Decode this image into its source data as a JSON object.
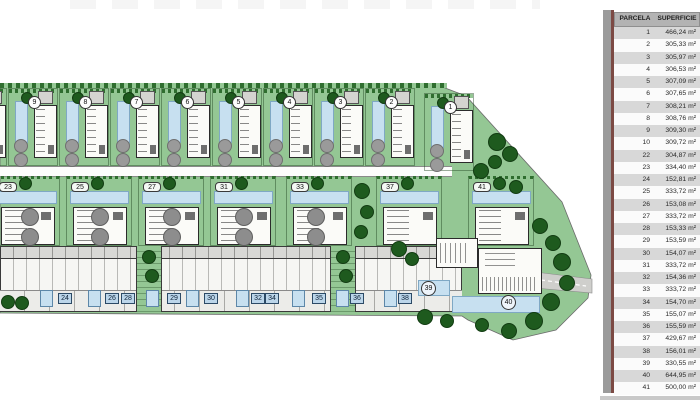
{
  "colors": {
    "site_green": "#94c794",
    "tree_green": "#1e5a1e",
    "pool_blue": "#c7e0f0",
    "road_gray": "#cfcfcc",
    "table_header_bg": "#b3b3b3",
    "table_row_gray": "#d8d8d8",
    "divider_red": "#7c4a44"
  },
  "table": {
    "headers": [
      "PARCELA",
      "SUPERFICIE"
    ],
    "rows": [
      {
        "parcela": "1",
        "superficie": "466,24 m²"
      },
      {
        "parcela": "2",
        "superficie": "305,33 m²"
      },
      {
        "parcela": "3",
        "superficie": "305,97 m²"
      },
      {
        "parcela": "4",
        "superficie": "306,53 m²"
      },
      {
        "parcela": "5",
        "superficie": "307,09 m²"
      },
      {
        "parcela": "6",
        "superficie": "307,65 m²"
      },
      {
        "parcela": "7",
        "superficie": "308,21 m²"
      },
      {
        "parcela": "8",
        "superficie": "308,76 m²"
      },
      {
        "parcela": "9",
        "superficie": "309,30 m²"
      },
      {
        "parcela": "10",
        "superficie": "309,72 m²"
      },
      {
        "parcela": "22",
        "superficie": "304,87 m²"
      },
      {
        "parcela": "23",
        "superficie": "334,40 m²"
      },
      {
        "parcela": "24",
        "superficie": "152,81 m²"
      },
      {
        "parcela": "25",
        "superficie": "333,72 m²"
      },
      {
        "parcela": "26",
        "superficie": "153,08 m²"
      },
      {
        "parcela": "27",
        "superficie": "333,72 m²"
      },
      {
        "parcela": "28",
        "superficie": "153,33 m²"
      },
      {
        "parcela": "29",
        "superficie": "153,59 m²"
      },
      {
        "parcela": "30",
        "superficie": "154,07 m²"
      },
      {
        "parcela": "31",
        "superficie": "333,72 m²"
      },
      {
        "parcela": "32",
        "superficie": "154,36 m²"
      },
      {
        "parcela": "33",
        "superficie": "333,72 m²"
      },
      {
        "parcela": "34",
        "superficie": "154,70 m²"
      },
      {
        "parcela": "35",
        "superficie": "155,07 m²"
      },
      {
        "parcela": "36",
        "superficie": "155,59 m²"
      },
      {
        "parcela": "37",
        "superficie": "429,67 m²"
      },
      {
        "parcela": "38",
        "superficie": "156,01 m²"
      },
      {
        "parcela": "39",
        "superficie": "330,55 m²"
      },
      {
        "parcela": "40",
        "superficie": "644,95 m²"
      },
      {
        "parcela": "41",
        "superficie": "500,00 m²"
      }
    ]
  },
  "plan": {
    "corner_plots": {
      "p39": "39",
      "p40": "40"
    },
    "top_villas": [
      {
        "num": "10",
        "x": -43
      },
      {
        "num": "9",
        "x": 8
      },
      {
        "num": "8",
        "x": 59
      },
      {
        "num": "7",
        "x": 110
      },
      {
        "num": "6",
        "x": 161
      },
      {
        "num": "5",
        "x": 212
      },
      {
        "num": "4",
        "x": 263
      },
      {
        "num": "3",
        "x": 314
      },
      {
        "num": "2",
        "x": 365
      },
      {
        "num": "1",
        "x": 424,
        "y": 93
      }
    ],
    "middle_villas": [
      {
        "num": "23",
        "x": -6
      },
      {
        "num": "25",
        "x": 66
      },
      {
        "num": "27",
        "x": 138
      },
      {
        "num": "31",
        "x": 210
      },
      {
        "num": "33",
        "x": 286
      },
      {
        "num": "37",
        "x": 376
      },
      {
        "num": "41",
        "x": 468
      }
    ],
    "townhouse_labels": [
      {
        "num": "24",
        "x": 58
      },
      {
        "num": "26",
        "x": 105
      },
      {
        "num": "28",
        "x": 121
      },
      {
        "num": "29",
        "x": 167
      },
      {
        "num": "30",
        "x": 204
      },
      {
        "num": "32",
        "x": 251
      },
      {
        "num": "34",
        "x": 265
      },
      {
        "num": "35",
        "x": 312
      },
      {
        "num": "36",
        "x": 350
      },
      {
        "num": "38",
        "x": 398
      }
    ],
    "townhouse_pools": [
      {
        "x": 40
      },
      {
        "x": 88
      },
      {
        "x": 146
      },
      {
        "x": 186
      },
      {
        "x": 236
      },
      {
        "x": 292
      },
      {
        "x": 336
      },
      {
        "x": 384
      }
    ],
    "gray_pairs": [
      {
        "x": 21
      },
      {
        "x": 91
      },
      {
        "x": 163
      },
      {
        "x": 235
      },
      {
        "x": 307
      }
    ],
    "trees": [
      {
        "x": 488,
        "y": 133,
        "s": 18
      },
      {
        "x": 502,
        "y": 146,
        "s": 16
      },
      {
        "x": 488,
        "y": 155,
        "s": 14
      },
      {
        "x": 473,
        "y": 163,
        "s": 16
      },
      {
        "x": 509,
        "y": 180,
        "s": 14
      },
      {
        "x": 532,
        "y": 218,
        "s": 16
      },
      {
        "x": 545,
        "y": 235,
        "s": 16
      },
      {
        "x": 553,
        "y": 253,
        "s": 18
      },
      {
        "x": 559,
        "y": 275,
        "s": 16
      },
      {
        "x": 542,
        "y": 293,
        "s": 18
      },
      {
        "x": 525,
        "y": 312,
        "s": 18
      },
      {
        "x": 501,
        "y": 323,
        "s": 16
      },
      {
        "x": 475,
        "y": 318,
        "s": 14
      },
      {
        "x": 391,
        "y": 241,
        "s": 16
      },
      {
        "x": 405,
        "y": 252,
        "s": 14
      },
      {
        "x": 417,
        "y": 309,
        "s": 16
      },
      {
        "x": 440,
        "y": 314,
        "s": 14
      },
      {
        "x": 354,
        "y": 183,
        "s": 16
      },
      {
        "x": 360,
        "y": 205,
        "s": 14
      },
      {
        "x": 354,
        "y": 225,
        "s": 14
      },
      {
        "x": 142,
        "y": 250,
        "s": 14
      },
      {
        "x": 145,
        "y": 269,
        "s": 14
      },
      {
        "x": 336,
        "y": 250,
        "s": 14
      },
      {
        "x": 339,
        "y": 269,
        "s": 14
      },
      {
        "x": 1,
        "y": 295,
        "s": 14
      },
      {
        "x": 15,
        "y": 296,
        "s": 14
      }
    ]
  }
}
